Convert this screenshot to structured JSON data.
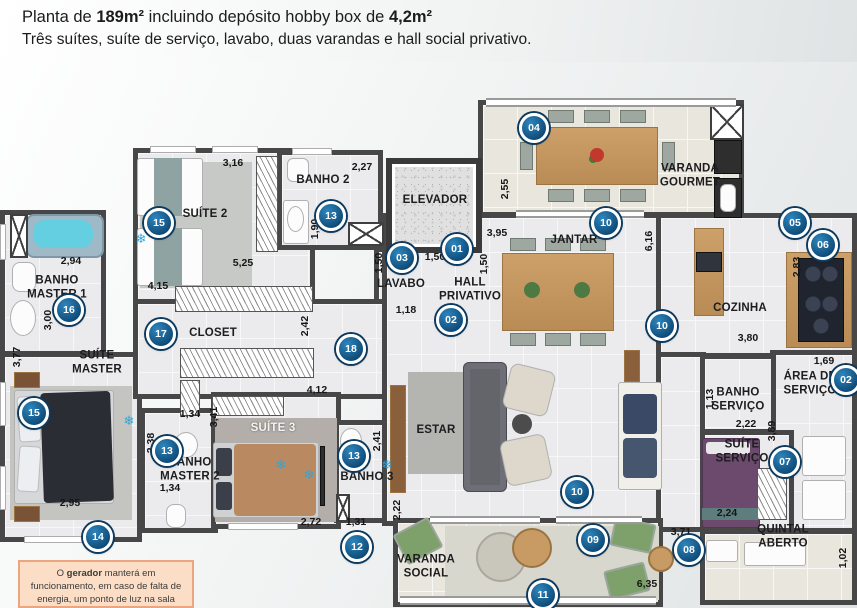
{
  "header": {
    "line1_a": "Planta de ",
    "line1_b": "189m²",
    "line1_c": " incluindo depósito hobby box de ",
    "line1_d": "4,2m²",
    "line2": "Três suítes, suíte de serviço, lavabo, duas varandas e hall social privativo."
  },
  "rooms": {
    "suite2": "SUÍTE 2",
    "banho2": "BANHO 2",
    "elevador": "ELEVADOR",
    "varanda_gourmet": "VARANDA\nGOURMET",
    "jantar": "JANTAR",
    "cozinha": "COZINHA",
    "lavabo": "LAVABO",
    "hall_privativo": "HALL\nPRIVATIVO",
    "closet": "CLOSET",
    "banho_master1": "BANHO\nMASTER 1",
    "suite_master": "SUÍTE\nMASTER",
    "area_servico": "ÁREA DE\nSERVIÇO",
    "banho_servico": "BANHO\nSERVIÇO",
    "suite_servico": "SUÍTE\nSERVIÇO",
    "quintal_aberto": "QUINTAL ABERTO",
    "suite3": "SUÍTE 3",
    "banho_master2": "BANHO\nMASTER 2",
    "banho3": "BANHO 3",
    "estar": "ESTAR",
    "varanda_social": "VARANDA\nSOCIAL"
  },
  "dims": {
    "suite2_top": "3,16",
    "banho2_top": "2,27",
    "banho2_h": "1,90",
    "suite2_w": "5,25",
    "closet_top": "4,15",
    "gourmet_h": "2,55",
    "jantar_top": "3,95",
    "jantar_h": "6,16",
    "cozinha_h": "2,83",
    "cozinha_w": "3,80",
    "area_w": "1,69",
    "bserv_h": "1,13",
    "bserv_w": "2,22",
    "sserv_h": "3,89",
    "sserv_w": "2,24",
    "quintal_top": "3,71",
    "quintal_h": "1,02",
    "vsocial_w": "6,35",
    "bm1_w": "2,94",
    "bm1_h": "3,00",
    "sm_h": "3,77",
    "sm_w": "2,95",
    "closet_h": "2,42",
    "lavabo_h": "1,50",
    "lavabo_w": "1,18",
    "hall_top": "1,50",
    "hall_h": "1,50",
    "suite3_top": "4,12",
    "bm2_top": "1,34",
    "suite3_h": "3,41",
    "bm2_h": "2,38",
    "bm2_w": "1,34",
    "banho3_h": "2,41",
    "suite3_w": "2,72",
    "banho3_w": "1,31",
    "vsocial_h": "2,22"
  },
  "badges": {
    "n01": "01",
    "n02": "02",
    "n03": "03",
    "n04": "04",
    "n05": "05",
    "n06": "06",
    "n07": "07",
    "n08": "08",
    "n09": "09",
    "n10": "10",
    "n11": "11",
    "n12": "12",
    "n13": "13",
    "n14": "14",
    "n15": "15",
    "n16": "16",
    "n17": "17",
    "n18": "18"
  },
  "icons": {
    "snowflake": "❄"
  },
  "note": {
    "a": "O ",
    "b": "gerador",
    "c": " manterá em funcionamento, em caso de falta de energia, um ponto de luz na sala"
  },
  "colors": {
    "badge_blue": "#0e4a77",
    "wall_gray": "#474747",
    "note_peach": "#fcdec7",
    "pool_cyan": "#63cfe0",
    "ac_blue": "#2aa7de"
  }
}
